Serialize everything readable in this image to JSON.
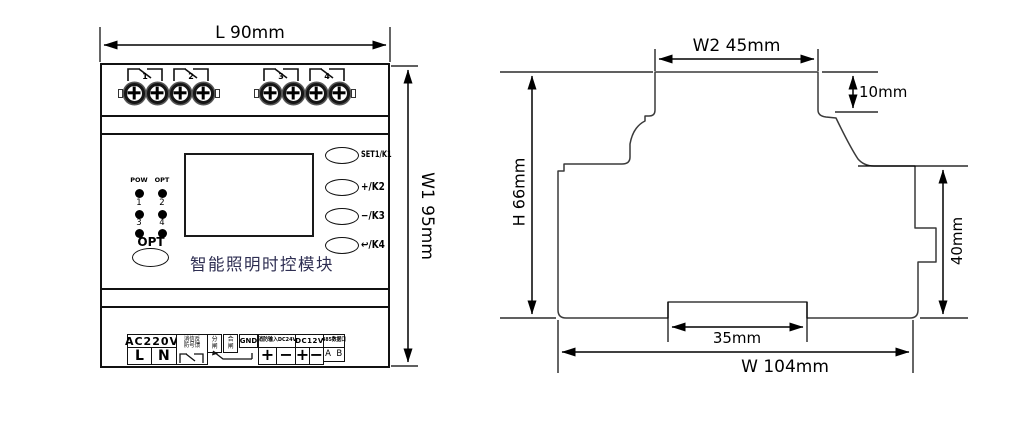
{
  "front_view": {
    "dim_l": "L   90mm",
    "dim_w1": "W1  95mm",
    "relay_contacts": [
      "1",
      "2",
      "3",
      "4"
    ],
    "panel": {
      "led_labels_row1": [
        "POW",
        "OPT"
      ],
      "led_labels_row2": [
        "1",
        "2"
      ],
      "led_labels_row3": [
        "3",
        "4"
      ],
      "opt_button_label": "OPT",
      "title": "智能照明时控模块",
      "buttons": [
        "SET1/K1",
        "+/K2",
        "−/K3",
        "↩/K4"
      ]
    },
    "terminals": {
      "ac_label": "AC220V",
      "ac_l": "L",
      "ac_n": "N",
      "fire_feedback_line1": "消信反",
      "fire_feedback_line2": "防号馈",
      "switch_open_top": "分",
      "switch_open_bottom": "闸",
      "switch_close_top": "合",
      "switch_close_bottom": "闸",
      "gnd": "GND",
      "fire_input": "消防输入DC24V",
      "fire_plus": "+",
      "fire_minus": "−",
      "dc12v": "DC12V",
      "dc_plus": "+",
      "dc_minus": "−",
      "rs485": "485数据口",
      "rs485_ab": "A  B"
    }
  },
  "side_view": {
    "dim_w2": "W2  45mm",
    "dim_10": "10mm",
    "dim_h": "H  66mm",
    "dim_40": "40mm",
    "dim_35": "35mm",
    "dim_w": "W   104mm"
  },
  "colors": {
    "line": "#111111",
    "title_text": "#2e2e52"
  }
}
